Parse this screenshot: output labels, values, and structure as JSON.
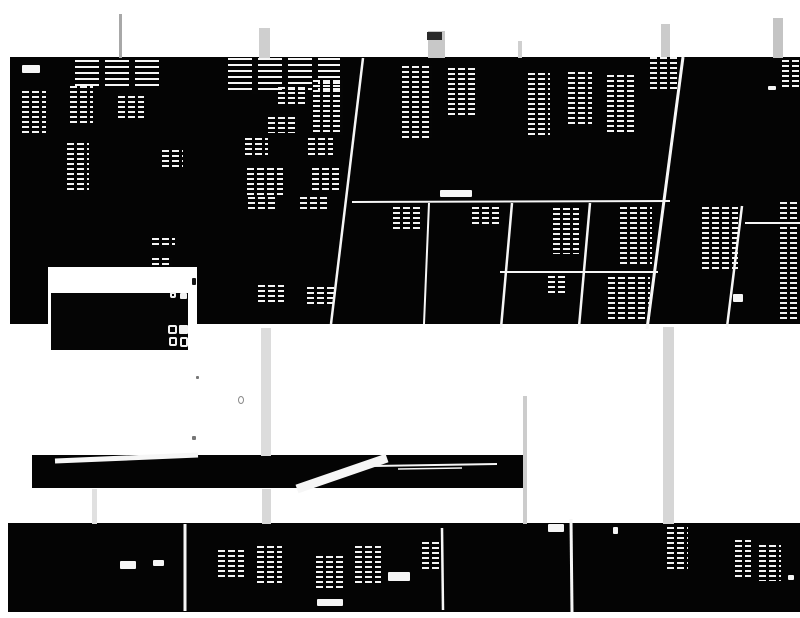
{
  "meta": {
    "kind": "binarized-degraded-scan",
    "canvas": {
      "width": 800,
      "height": 618
    },
    "palette": {
      "background": "#ffffff",
      "ink": "#040404",
      "fragment": "#f4f4f4",
      "streak_light": "#d6d6d6",
      "streak_dark": "#2a2a2a"
    },
    "readable_text": ""
  },
  "scene": {
    "panels": [
      {
        "name": "main-scan-band",
        "x": 10,
        "y": 57,
        "w": 790,
        "h": 267
      },
      {
        "name": "middle-scan-bar",
        "x": 32,
        "y": 455,
        "w": 493,
        "h": 33
      },
      {
        "name": "bottom-scan-band",
        "x": 8,
        "y": 523,
        "w": 792,
        "h": 89
      }
    ],
    "streaks": [
      {
        "name": "fold-streak",
        "x": 119,
        "y": 14,
        "w": 3,
        "h": 44,
        "color": "#a8a8a8"
      },
      {
        "name": "fold-streak",
        "x": 259,
        "y": 28,
        "w": 11,
        "h": 30,
        "color": "#cfcfcf"
      },
      {
        "name": "fold-streak",
        "x": 428,
        "y": 31,
        "w": 17,
        "h": 27,
        "color": "#c8c8c8"
      },
      {
        "name": "fold-streak-cap",
        "x": 427,
        "y": 32,
        "w": 15,
        "h": 8,
        "color": "#2a2a2a"
      },
      {
        "name": "fold-streak",
        "x": 518,
        "y": 41,
        "w": 4,
        "h": 17,
        "color": "#cfcfcf"
      },
      {
        "name": "fold-streak",
        "x": 661,
        "y": 24,
        "w": 9,
        "h": 34,
        "color": "#cbcbcb"
      },
      {
        "name": "fold-streak",
        "x": 773,
        "y": 18,
        "w": 10,
        "h": 40,
        "color": "#c4c4c4"
      },
      {
        "name": "fold-streak",
        "x": 261,
        "y": 328,
        "w": 10,
        "h": 128,
        "color": "#dcdcdc"
      },
      {
        "name": "fold-streak",
        "x": 262,
        "y": 489,
        "w": 9,
        "h": 35,
        "color": "#d8d8d8"
      },
      {
        "name": "fold-streak",
        "x": 92,
        "y": 489,
        "w": 5,
        "h": 35,
        "color": "#e0e0e0"
      },
      {
        "name": "fold-streak",
        "x": 523,
        "y": 396,
        "w": 4,
        "h": 128,
        "color": "#cccccc"
      },
      {
        "name": "fold-streak",
        "x": 663,
        "y": 327,
        "w": 11,
        "h": 197,
        "color": "#d6d6d6"
      }
    ],
    "fragments": [
      {
        "x": 22,
        "y": 65,
        "w": 18,
        "h": 8,
        "kind": "dash"
      },
      {
        "x": 75,
        "y": 60,
        "w": 85,
        "h": 30,
        "kind": "lines"
      },
      {
        "x": 228,
        "y": 58,
        "w": 112,
        "h": 36,
        "kind": "lines"
      },
      {
        "x": 22,
        "y": 91,
        "w": 24,
        "h": 42,
        "kind": "text"
      },
      {
        "x": 70,
        "y": 86,
        "w": 23,
        "h": 38,
        "kind": "text"
      },
      {
        "x": 118,
        "y": 96,
        "w": 26,
        "h": 25,
        "kind": "text"
      },
      {
        "x": 67,
        "y": 143,
        "w": 22,
        "h": 50,
        "kind": "text"
      },
      {
        "x": 162,
        "y": 150,
        "w": 21,
        "h": 20,
        "kind": "text"
      },
      {
        "x": 278,
        "y": 87,
        "w": 30,
        "h": 17,
        "kind": "text"
      },
      {
        "x": 313,
        "y": 80,
        "w": 30,
        "h": 55,
        "kind": "text"
      },
      {
        "x": 268,
        "y": 117,
        "w": 30,
        "h": 16,
        "kind": "text"
      },
      {
        "x": 245,
        "y": 138,
        "w": 23,
        "h": 18,
        "kind": "text"
      },
      {
        "x": 308,
        "y": 138,
        "w": 25,
        "h": 17,
        "kind": "text"
      },
      {
        "x": 247,
        "y": 168,
        "w": 36,
        "h": 27,
        "kind": "text"
      },
      {
        "x": 312,
        "y": 168,
        "w": 30,
        "h": 25,
        "kind": "text"
      },
      {
        "x": 402,
        "y": 66,
        "w": 30,
        "h": 72,
        "kind": "text"
      },
      {
        "x": 448,
        "y": 68,
        "w": 29,
        "h": 50,
        "kind": "text"
      },
      {
        "x": 528,
        "y": 73,
        "w": 22,
        "h": 62,
        "kind": "text"
      },
      {
        "x": 568,
        "y": 72,
        "w": 24,
        "h": 52,
        "kind": "text"
      },
      {
        "x": 607,
        "y": 75,
        "w": 28,
        "h": 58,
        "kind": "text"
      },
      {
        "x": 650,
        "y": 57,
        "w": 30,
        "h": 35,
        "kind": "text"
      },
      {
        "x": 782,
        "y": 60,
        "w": 18,
        "h": 28,
        "kind": "text"
      },
      {
        "x": 248,
        "y": 197,
        "w": 30,
        "h": 14,
        "kind": "text"
      },
      {
        "x": 300,
        "y": 197,
        "w": 28,
        "h": 14,
        "kind": "text"
      },
      {
        "x": 152,
        "y": 238,
        "w": 23,
        "h": 10,
        "kind": "text"
      },
      {
        "x": 152,
        "y": 258,
        "w": 20,
        "h": 9,
        "kind": "text"
      },
      {
        "x": 258,
        "y": 285,
        "w": 26,
        "h": 20,
        "kind": "text"
      },
      {
        "x": 307,
        "y": 287,
        "w": 27,
        "h": 20,
        "kind": "text"
      },
      {
        "x": 440,
        "y": 190,
        "w": 32,
        "h": 7,
        "kind": "dash"
      },
      {
        "x": 768,
        "y": 86,
        "w": 8,
        "h": 4,
        "kind": "dash"
      },
      {
        "x": 393,
        "y": 207,
        "w": 30,
        "h": 24,
        "kind": "text"
      },
      {
        "x": 472,
        "y": 207,
        "w": 28,
        "h": 20,
        "kind": "text"
      },
      {
        "x": 553,
        "y": 208,
        "w": 26,
        "h": 46,
        "kind": "text"
      },
      {
        "x": 620,
        "y": 207,
        "w": 32,
        "h": 60,
        "kind": "text"
      },
      {
        "x": 702,
        "y": 207,
        "w": 36,
        "h": 62,
        "kind": "text"
      },
      {
        "x": 780,
        "y": 202,
        "w": 20,
        "h": 120,
        "kind": "text"
      },
      {
        "x": 548,
        "y": 276,
        "w": 18,
        "h": 20,
        "kind": "text"
      },
      {
        "x": 608,
        "y": 277,
        "w": 42,
        "h": 45,
        "kind": "text"
      },
      {
        "x": 733,
        "y": 294,
        "w": 10,
        "h": 8,
        "kind": "dash"
      },
      {
        "x": 120,
        "y": 561,
        "w": 16,
        "h": 8,
        "kind": "dash"
      },
      {
        "x": 153,
        "y": 560,
        "w": 11,
        "h": 6,
        "kind": "dash"
      },
      {
        "x": 218,
        "y": 550,
        "w": 26,
        "h": 28,
        "kind": "text"
      },
      {
        "x": 257,
        "y": 546,
        "w": 25,
        "h": 40,
        "kind": "text"
      },
      {
        "x": 316,
        "y": 556,
        "w": 28,
        "h": 33,
        "kind": "text"
      },
      {
        "x": 355,
        "y": 546,
        "w": 26,
        "h": 38,
        "kind": "text"
      },
      {
        "x": 388,
        "y": 572,
        "w": 22,
        "h": 9,
        "kind": "dash"
      },
      {
        "x": 422,
        "y": 542,
        "w": 18,
        "h": 30,
        "kind": "text"
      },
      {
        "x": 317,
        "y": 599,
        "w": 26,
        "h": 7,
        "kind": "dash"
      },
      {
        "x": 548,
        "y": 524,
        "w": 16,
        "h": 8,
        "kind": "dash"
      },
      {
        "x": 613,
        "y": 527,
        "w": 5,
        "h": 7,
        "kind": "dash"
      },
      {
        "x": 667,
        "y": 527,
        "w": 21,
        "h": 44,
        "kind": "text"
      },
      {
        "x": 735,
        "y": 540,
        "w": 16,
        "h": 40,
        "kind": "text"
      },
      {
        "x": 759,
        "y": 545,
        "w": 22,
        "h": 36,
        "kind": "text"
      },
      {
        "x": 788,
        "y": 575,
        "w": 6,
        "h": 5,
        "kind": "dash"
      },
      {
        "x": 399,
        "y": 574,
        "w": 8,
        "h": 7,
        "kind": "dash"
      }
    ],
    "lines": [
      {
        "name": "diagonal-rule",
        "x1": 363,
        "y1": 58,
        "x2": 331,
        "y2": 324,
        "w": 2.5
      },
      {
        "name": "diagonal-rule",
        "x1": 512,
        "y1": 203,
        "x2": 501,
        "y2": 328,
        "w": 2.5
      },
      {
        "name": "diagonal-rule",
        "x1": 683,
        "y1": 57,
        "x2": 647,
        "y2": 329,
        "w": 3
      },
      {
        "name": "diagonal-rule",
        "x1": 742,
        "y1": 206,
        "x2": 727,
        "y2": 327,
        "w": 2.5
      },
      {
        "name": "diagonal-rule",
        "x1": 590,
        "y1": 203,
        "x2": 579,
        "y2": 327,
        "w": 2.5
      },
      {
        "name": "diagonal-rule",
        "x1": 429,
        "y1": 203,
        "x2": 424,
        "y2": 324,
        "w": 2
      },
      {
        "name": "horizontal-rule",
        "x1": 352,
        "y1": 202,
        "x2": 670,
        "y2": 201,
        "w": 2
      },
      {
        "name": "horizontal-rule",
        "x1": 745,
        "y1": 223,
        "x2": 800,
        "y2": 223,
        "w": 2
      },
      {
        "name": "horizontal-rule",
        "x1": 500,
        "y1": 272,
        "x2": 658,
        "y2": 272,
        "w": 2
      },
      {
        "name": "bottom-divider",
        "x1": 185,
        "y1": 524,
        "x2": 185,
        "y2": 611,
        "w": 3
      },
      {
        "name": "bottom-divider",
        "x1": 442,
        "y1": 528,
        "x2": 443,
        "y2": 610,
        "w": 2.5
      },
      {
        "name": "bottom-divider",
        "x1": 571,
        "y1": 519,
        "x2": 572,
        "y2": 612,
        "w": 3
      },
      {
        "name": "bar-glare",
        "x1": 55,
        "y1": 461,
        "x2": 198,
        "y2": 455,
        "w": 5
      },
      {
        "name": "bar-glare",
        "x1": 297,
        "y1": 489,
        "x2": 387,
        "y2": 458,
        "w": 9
      },
      {
        "name": "bar-glare",
        "x1": 372,
        "y1": 466,
        "x2": 497,
        "y2": 464,
        "w": 2
      },
      {
        "name": "bar-glare",
        "x1": 398,
        "y1": 469,
        "x2": 462,
        "y2": 468,
        "w": 1.5
      }
    ],
    "overlay_box": {
      "white": {
        "x": 48,
        "y": 267,
        "w": 149,
        "h": 86
      },
      "black": {
        "x": 51,
        "y": 293,
        "w": 137,
        "h": 57
      },
      "glyphs": [
        {
          "name": "box-glyph",
          "x": 170,
          "y": 292,
          "w": 6,
          "h": 6,
          "style": "outline"
        },
        {
          "name": "box-glyph",
          "x": 180,
          "y": 293,
          "w": 7,
          "h": 6,
          "style": "solid"
        },
        {
          "name": "box-glyph",
          "x": 168,
          "y": 325,
          "w": 9,
          "h": 9,
          "style": "outline"
        },
        {
          "name": "box-glyph",
          "x": 179,
          "y": 325,
          "w": 9,
          "h": 9,
          "style": "solid"
        },
        {
          "name": "box-glyph",
          "x": 169,
          "y": 337,
          "w": 8,
          "h": 9,
          "style": "outline"
        },
        {
          "name": "box-glyph",
          "x": 180,
          "y": 337,
          "w": 8,
          "h": 10,
          "style": "outline"
        }
      ]
    },
    "marks": [
      {
        "name": "ink-speck",
        "x": 192,
        "y": 278,
        "w": 4,
        "h": 7,
        "color": "#151515",
        "style": "solid"
      },
      {
        "name": "ink-ring",
        "x": 238,
        "y": 396,
        "w": 6,
        "h": 8,
        "color": "#8a8a8a",
        "style": "ring"
      },
      {
        "name": "ink-speck",
        "x": 196,
        "y": 376,
        "w": 3,
        "h": 3,
        "color": "#777777",
        "style": "solid"
      },
      {
        "name": "ink-speck",
        "x": 192,
        "y": 436,
        "w": 4,
        "h": 4,
        "color": "#777777",
        "style": "solid"
      }
    ]
  }
}
